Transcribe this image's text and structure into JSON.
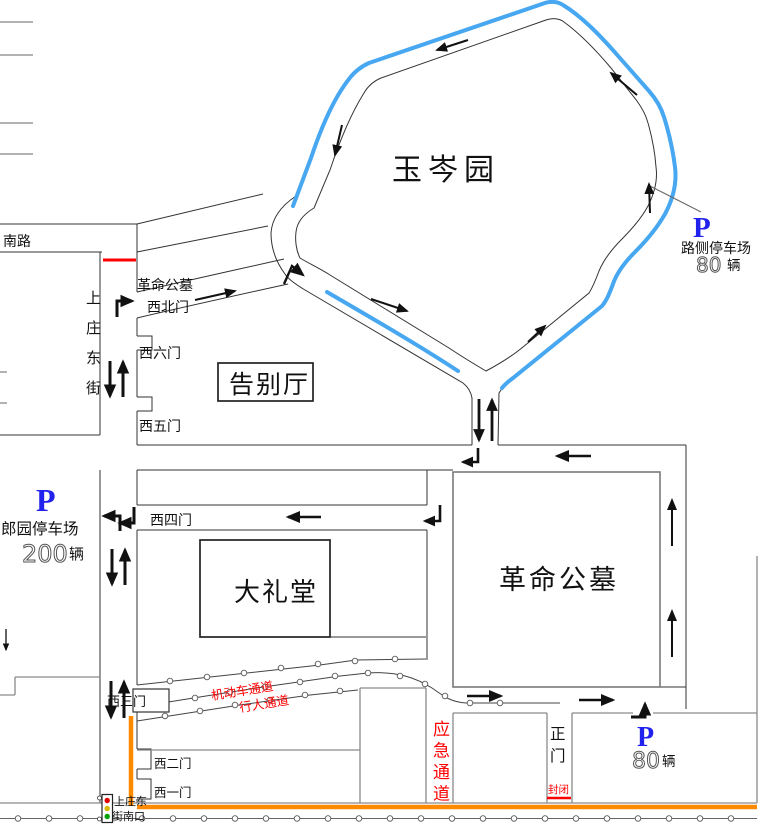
{
  "map": {
    "garden": "玉岑园",
    "cemetery": "革命公墓",
    "great_hall": "大礼堂",
    "farewell_hall": "告别厅",
    "south_road": "南路",
    "street_vertical": "上庄东街",
    "nw_gate_line1": "革命公墓",
    "nw_gate_line2": "西北门",
    "gate_w6": "西六门",
    "gate_w5": "西五门",
    "gate_w4": "西四门",
    "gate_w3": "西三门",
    "gate_w2": "西二门",
    "gate_w1": "西一门",
    "main_gate": "正门",
    "closed": "封闭",
    "emergency": "应急通道",
    "motor_lane": "机动车通道",
    "pedestrian_lane": "行人通道",
    "signal_line1": "上庄东",
    "signal_line2": "街南口"
  },
  "parking": {
    "roadside": {
      "symbol": "P",
      "name": "路侧停车场",
      "count": "80",
      "unit": "辆"
    },
    "langyuan": {
      "symbol": "P",
      "name": "郎园停车场",
      "count": "200",
      "unit": "辆"
    },
    "main_gate_lot": {
      "symbol": "P",
      "count": "80",
      "unit": "辆"
    }
  },
  "colors": {
    "highlight_blue": "#47a7f0",
    "parking_blue": "#2222ee",
    "alert_red": "#ff0000",
    "closure_orange": "#ff8a00"
  }
}
